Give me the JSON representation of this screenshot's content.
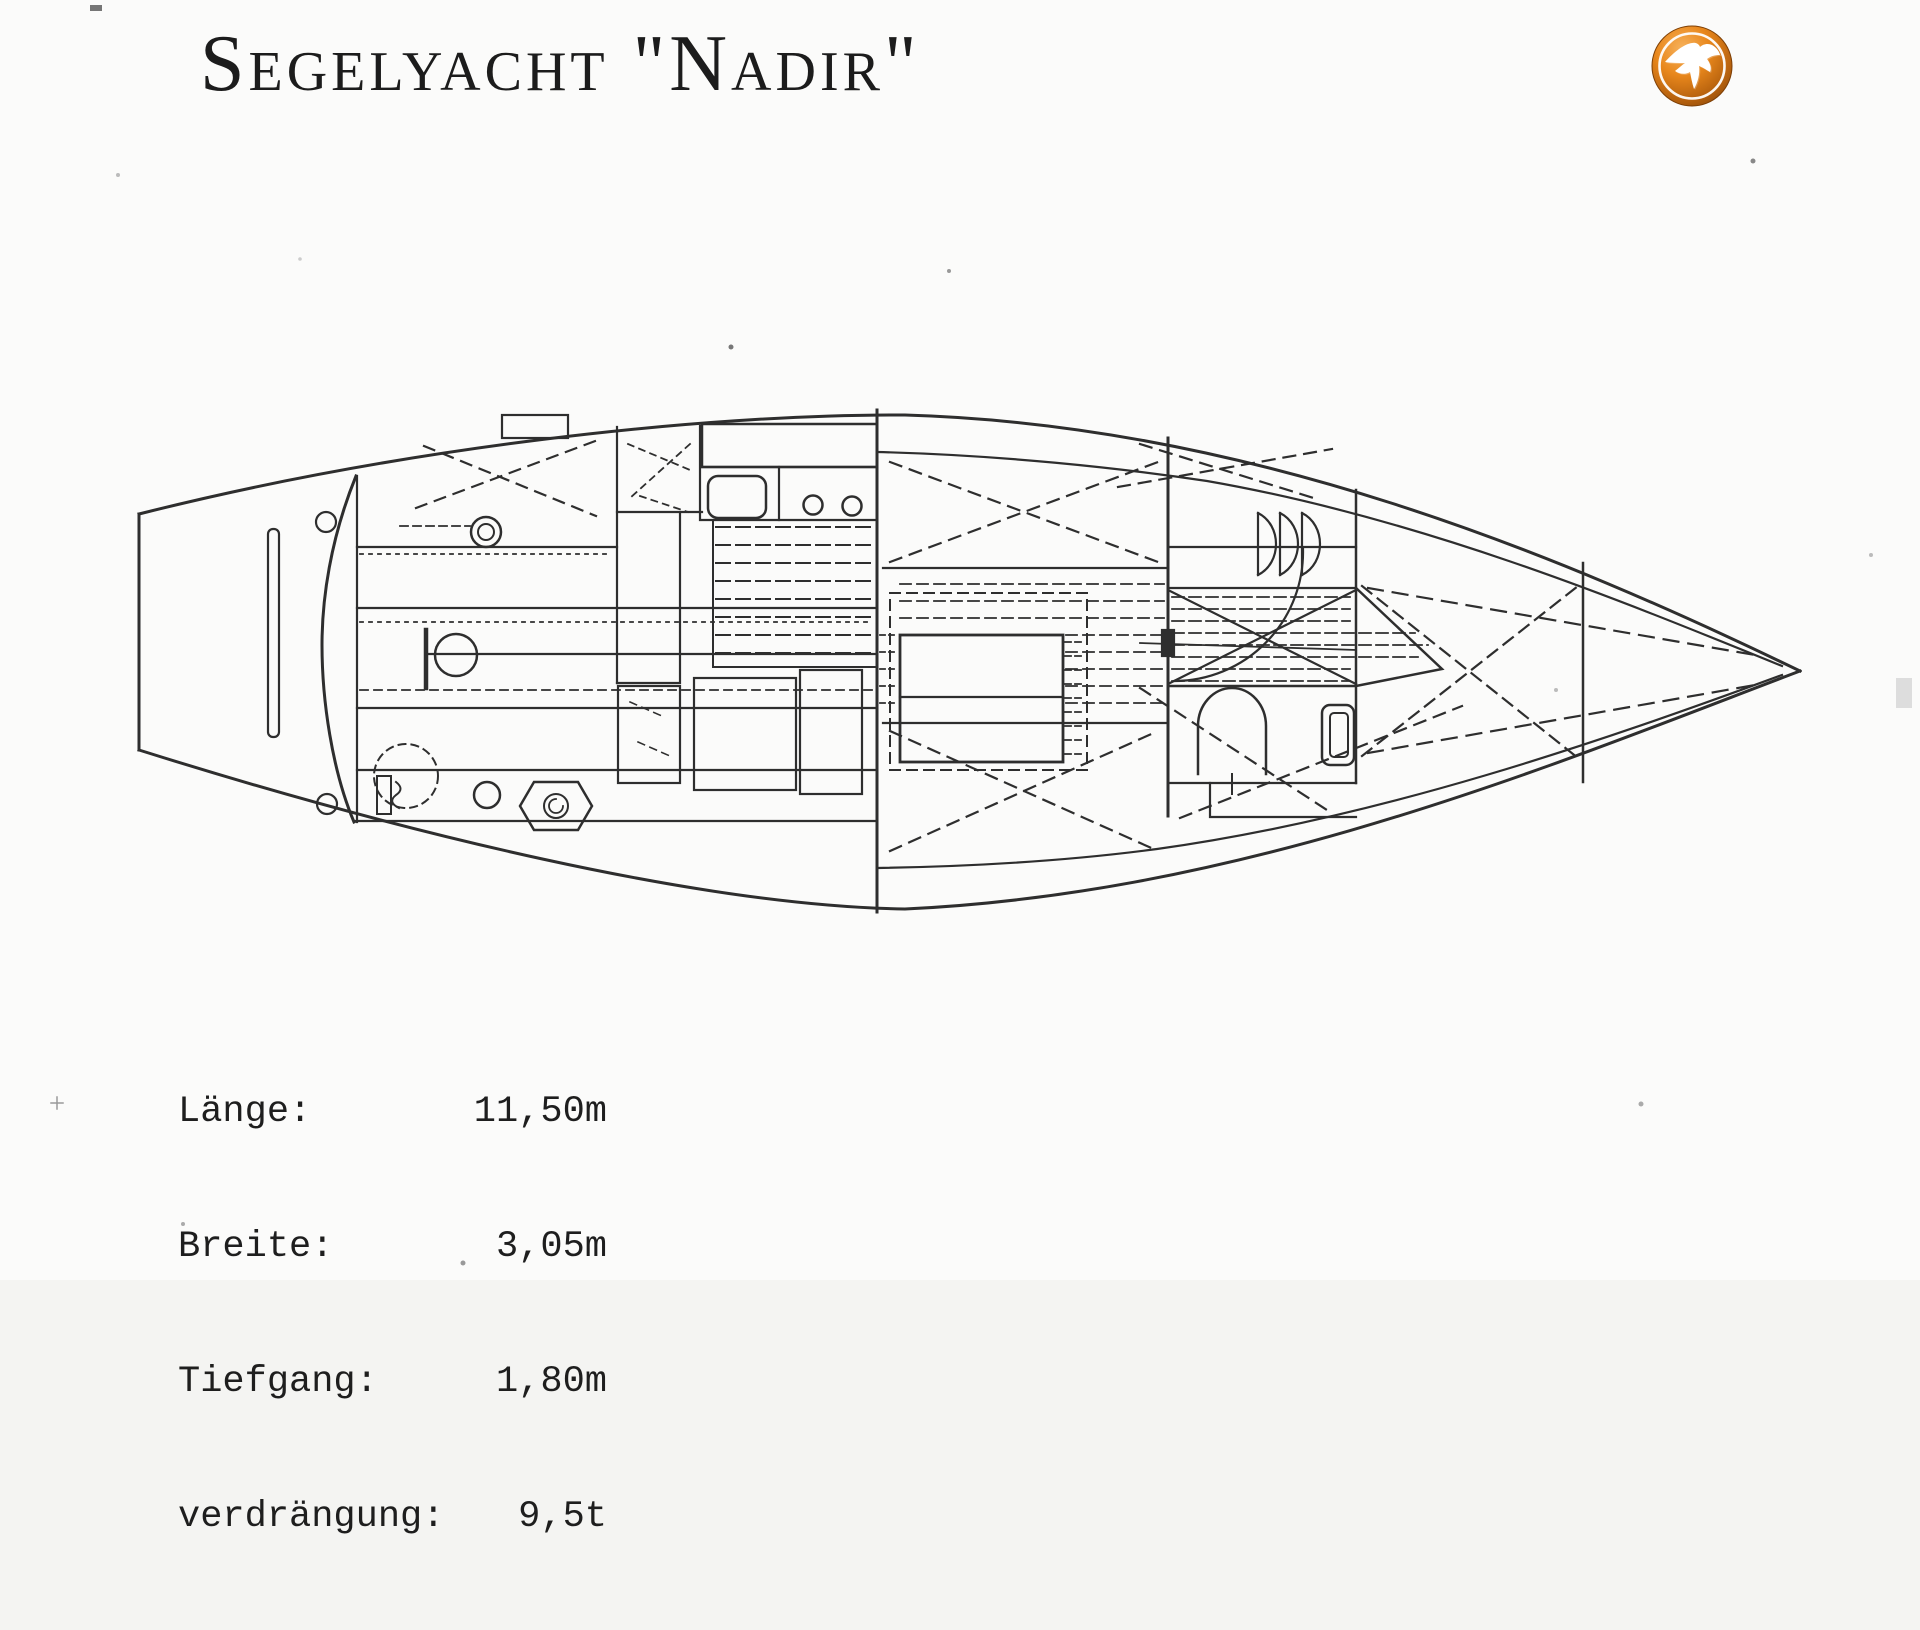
{
  "header": {
    "title": "Segelyacht \"Nadir\""
  },
  "logo": {
    "icon": "seagull-badge",
    "orange_light": "#f5ae56",
    "orange_mid": "#e2830f",
    "orange_dark": "#8a4708",
    "ring_color": "#ffffff",
    "bird_color": "#ffffff"
  },
  "drawing": {
    "name": "yacht-interior-deck-plan",
    "ink_color": "#2e2e2e",
    "features": [
      "transom",
      "cockpit-benches",
      "tiller",
      "compass",
      "winches",
      "companionway-hatch",
      "galley-sink",
      "two-burner-stove",
      "cabin-sole-hatching",
      "port-settee-berth",
      "starboard-settee-berth",
      "saloon-table",
      "mast",
      "hanging-locker",
      "head-door-arch",
      "door-swing-arc",
      "v-berth",
      "chain-locker-bulkhead",
      "bow"
    ]
  },
  "specs": {
    "rows": [
      {
        "label": "Länge:",
        "value": "11,50m"
      },
      {
        "label": "Breite:",
        "value": "3,05m"
      },
      {
        "label": "Tiefgang:",
        "value": "1,80m"
      },
      {
        "label": "verdrängung:",
        "value": "9,5t"
      }
    ]
  }
}
